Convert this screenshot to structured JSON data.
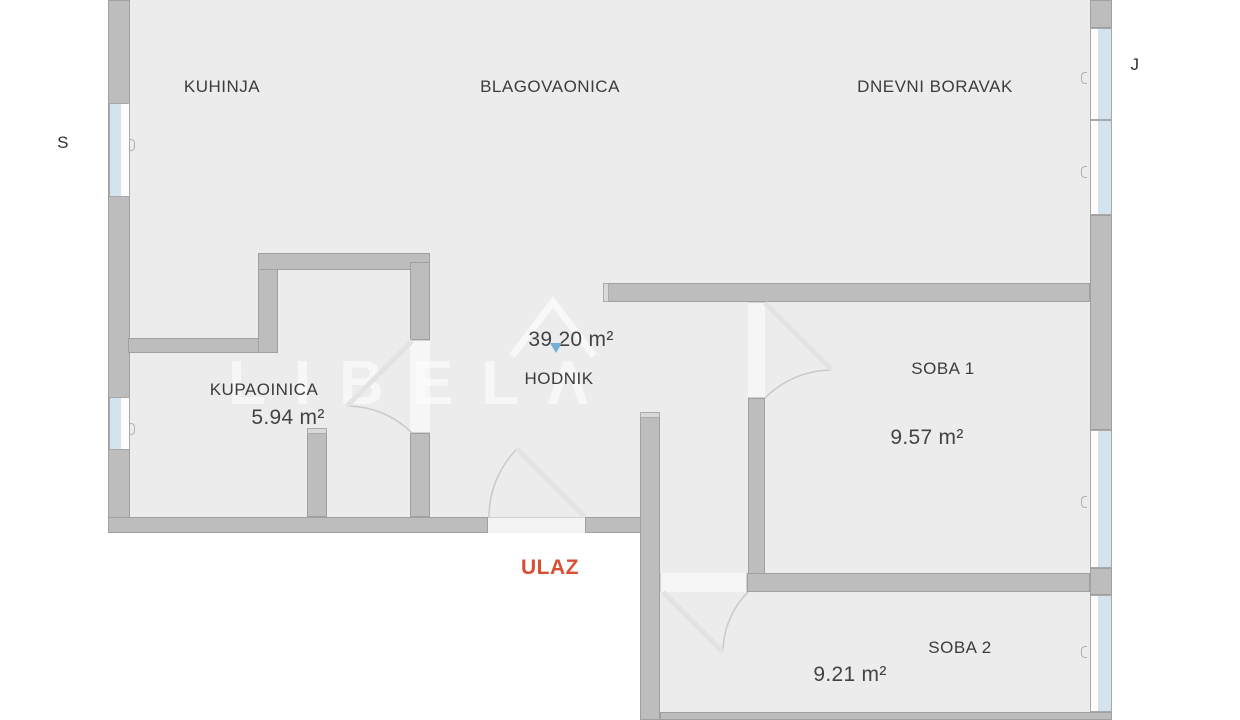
{
  "plan": {
    "rooms": {
      "kuhinja": {
        "label": "KUHINJA"
      },
      "blagovaonica": {
        "label": "BLAGOVAONICA"
      },
      "dnevni_boravak": {
        "label": "DNEVNI BORAVAK"
      },
      "kupaonica": {
        "label": "KUPAOINICA",
        "area": "5.94 m²"
      },
      "hodnik": {
        "label": "HODNIK",
        "area": "39.20 m²"
      },
      "soba1": {
        "label": "SOBA 1",
        "area": "9.57 m²"
      },
      "soba2": {
        "label": "SOBA 2",
        "area": "9.21 m²"
      }
    },
    "entrance": {
      "label": "ULAZ"
    },
    "orientation": {
      "left": "S",
      "right": "J"
    },
    "watermark": {
      "text": "LIBELΛ"
    },
    "colors": {
      "wall": "#bdbdbd",
      "floor": "#ececec",
      "window_glass": "#d3e4ee",
      "entrance_text": "#d85033",
      "label_text": "#3c3c3c",
      "marker_pin": "#73b1d6",
      "watermark": "#ffffff"
    }
  }
}
